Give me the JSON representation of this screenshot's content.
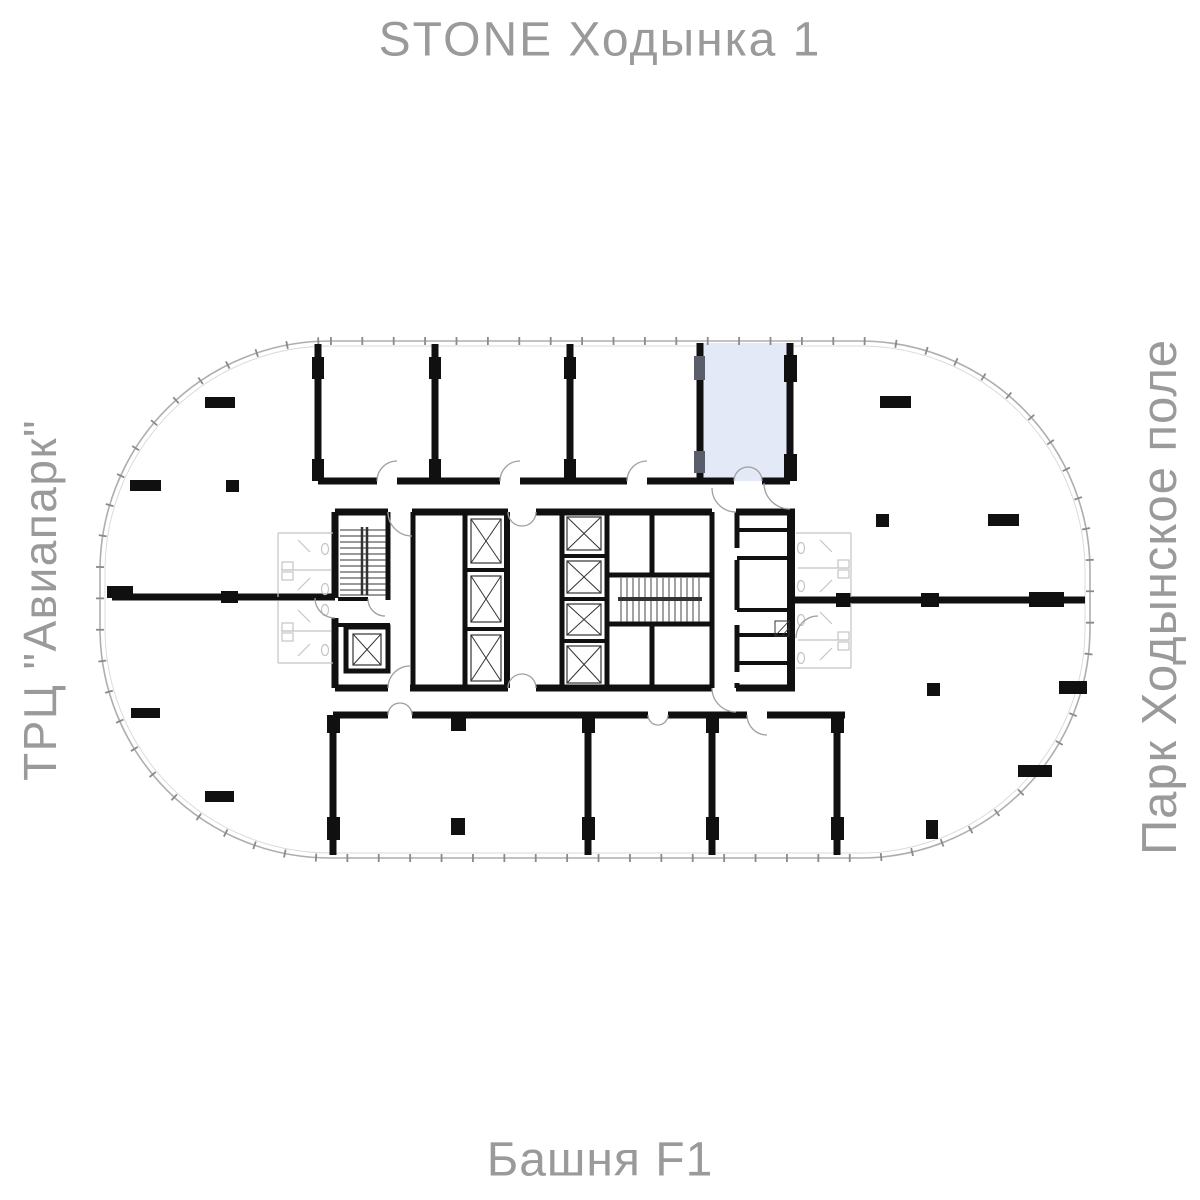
{
  "title": "STONE Ходынка 1",
  "labels": {
    "left": "ТРЦ \"Авиапарк\"",
    "right": "Парк Ходынское поле",
    "bottom": "Башня F1"
  },
  "plan": {
    "tower_name": "Башня F1",
    "selected_unit_fill": "#e4e9f8",
    "wall_color": "#101010",
    "glass_line_color": "#9a9a9a",
    "label_text_color": "#9a9a9a"
  }
}
